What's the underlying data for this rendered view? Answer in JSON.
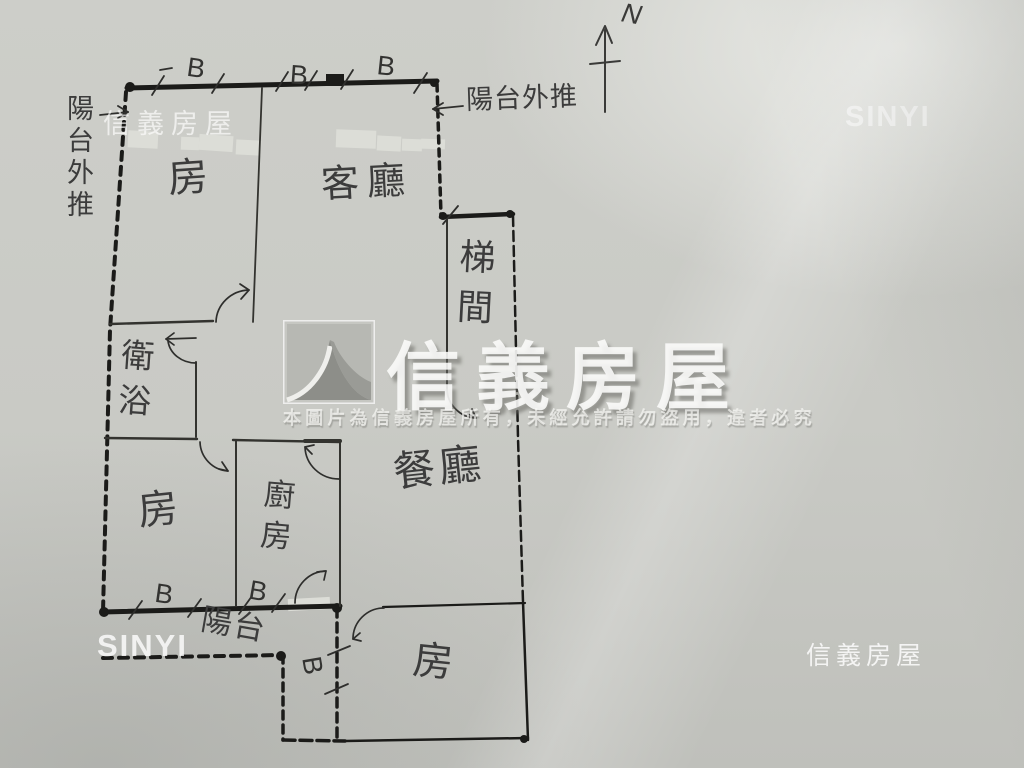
{
  "watermarks": {
    "top_left": "信義房屋",
    "top_right": "SINYI",
    "bottom_left": "SINYI",
    "bottom_right": "信義房屋",
    "center_brand": "信義房屋",
    "disclaimer": "本圖片為信義房屋所有，未經允許請勿盜用，違者必究"
  },
  "compass": {
    "label": "N"
  },
  "rooms": {
    "bedroom_top": "房",
    "living": "客廳",
    "stairwell": "梯間",
    "bath": "衛浴",
    "bedroom_mid": "房",
    "kitchen": "廚房",
    "dining": "餐廳",
    "balcony": "陽台",
    "bedroom_bottom": "房"
  },
  "annotations": {
    "balcony_ext_left": "陽台外推",
    "balcony_ext_top": "陽台外推",
    "window_marks": [
      "B",
      "B",
      "B",
      "B",
      "B",
      "B"
    ]
  },
  "colors": {
    "paper": "#c9cac5",
    "pencil": "#3c3c3c",
    "wall": "#1b1b19",
    "tape": "#dcddd7",
    "watermark": "#ffffff"
  }
}
